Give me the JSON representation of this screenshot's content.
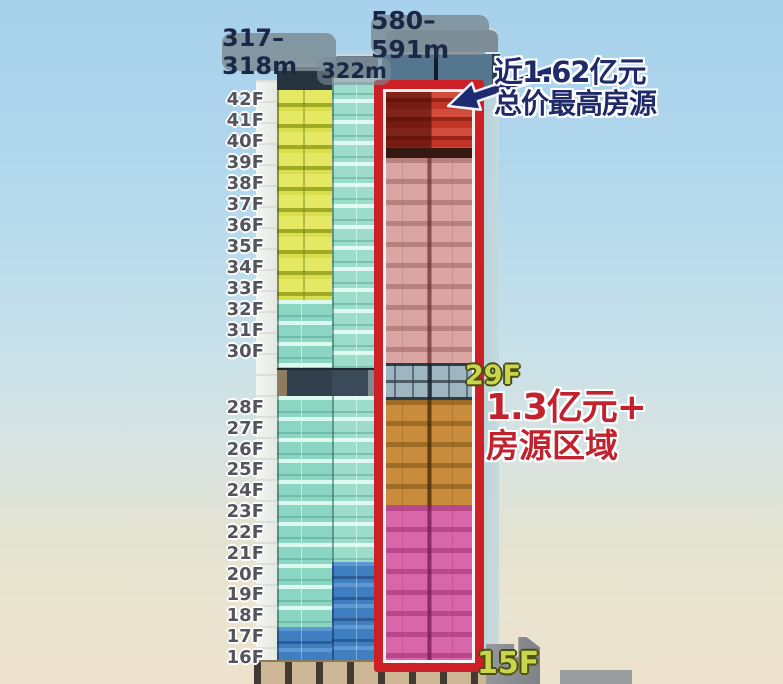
{
  "height_pills": {
    "left": "317–318m",
    "middle": "322m",
    "right": "580–591m"
  },
  "floor_axis": {
    "upper": [
      "42F",
      "41F",
      "40F",
      "39F",
      "38F",
      "37F",
      "36F",
      "35F",
      "34F",
      "33F",
      "32F",
      "31F",
      "30F"
    ],
    "lower": [
      "28F",
      "27F",
      "26F",
      "25F",
      "24F",
      "23F",
      "22F",
      "21F",
      "20F",
      "19F",
      "18F",
      "17F",
      "16F"
    ]
  },
  "callouts": {
    "top_price_line1": "近1.62亿元",
    "top_price_line2": "总价最高房源",
    "zone_floor_top": "29F",
    "zone_price_line1": "1.3亿元+",
    "zone_price_line2": "房源区域",
    "zone_floor_bottom": "15F"
  },
  "colors": {
    "highlight_box_red": "#cd2026",
    "top_section_red": "#c03527",
    "pink_section": "#daa5a3",
    "orange_section": "#c98b3c",
    "magenta_section": "#d867a9",
    "yellow_section": "#dce14d",
    "teal_section": "#8ad6c2",
    "blue_section": "#3e7ec1",
    "callout_navy": "#202a68",
    "price_red": "#c0232e",
    "floor_tag_yellow": "#c9d64c",
    "pill_gray": "#7d8e98"
  }
}
